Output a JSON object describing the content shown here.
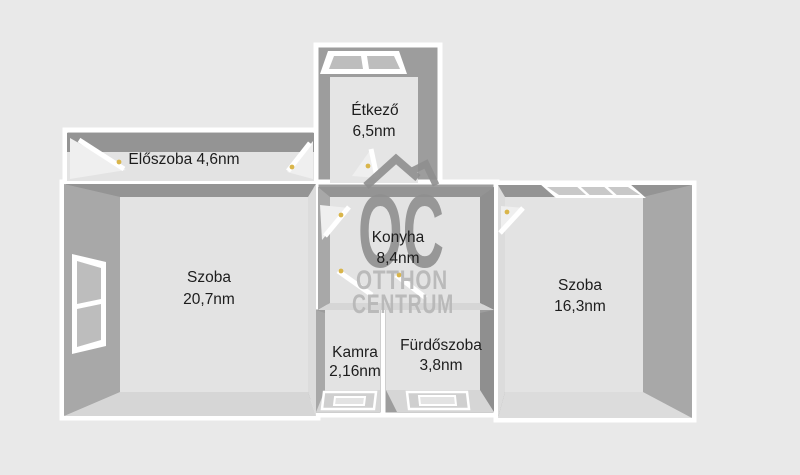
{
  "plan": {
    "type": "apartment-floor-plan",
    "area_unit": "nm"
  },
  "rooms": {
    "eloszoba": {
      "label": "Előszoba 4,6nm",
      "name": "Előszoba",
      "area": "4,6nm"
    },
    "etkezo": {
      "name": "Étkező",
      "area": "6,5nm"
    },
    "konyha": {
      "name": "Konyha",
      "area": "8,4nm"
    },
    "szoba_left": {
      "name": "Szoba",
      "area": "20,7nm"
    },
    "szoba_right": {
      "name": "Szoba",
      "area": "16,3nm"
    },
    "kamra": {
      "name": "Kamra",
      "area": "2,16nm"
    },
    "furdoszoba": {
      "name": "Fürdőszoba",
      "area": "3,8nm"
    }
  },
  "watermark": {
    "logo": "OC",
    "brand_line1": "OTTHON",
    "brand_line2": "CENTRUM"
  },
  "colors": {
    "background": "#e9e9e9",
    "wall_white": "#ffffff",
    "wall_face": "#9d9d9d",
    "face_top": "#949494",
    "face_side": "#a8a8a8",
    "face_dark": "#8f8f8f",
    "face_bottom_light": "#d6d6d6",
    "face_inner_light": "#dcdcdc",
    "floor": "#e3e3e3",
    "floor_bright": "#e5e5e5",
    "pane": "#bdbdbd",
    "pane_dark": "#c8c8c8",
    "window_sill": "#cfcfcf",
    "door_swing": "#efefef",
    "handle_accent": "#d9b54a",
    "label_text": "#1d1d1d",
    "watermark_logo": "#8f8f8f",
    "watermark_brand": "#b6b6b6"
  }
}
